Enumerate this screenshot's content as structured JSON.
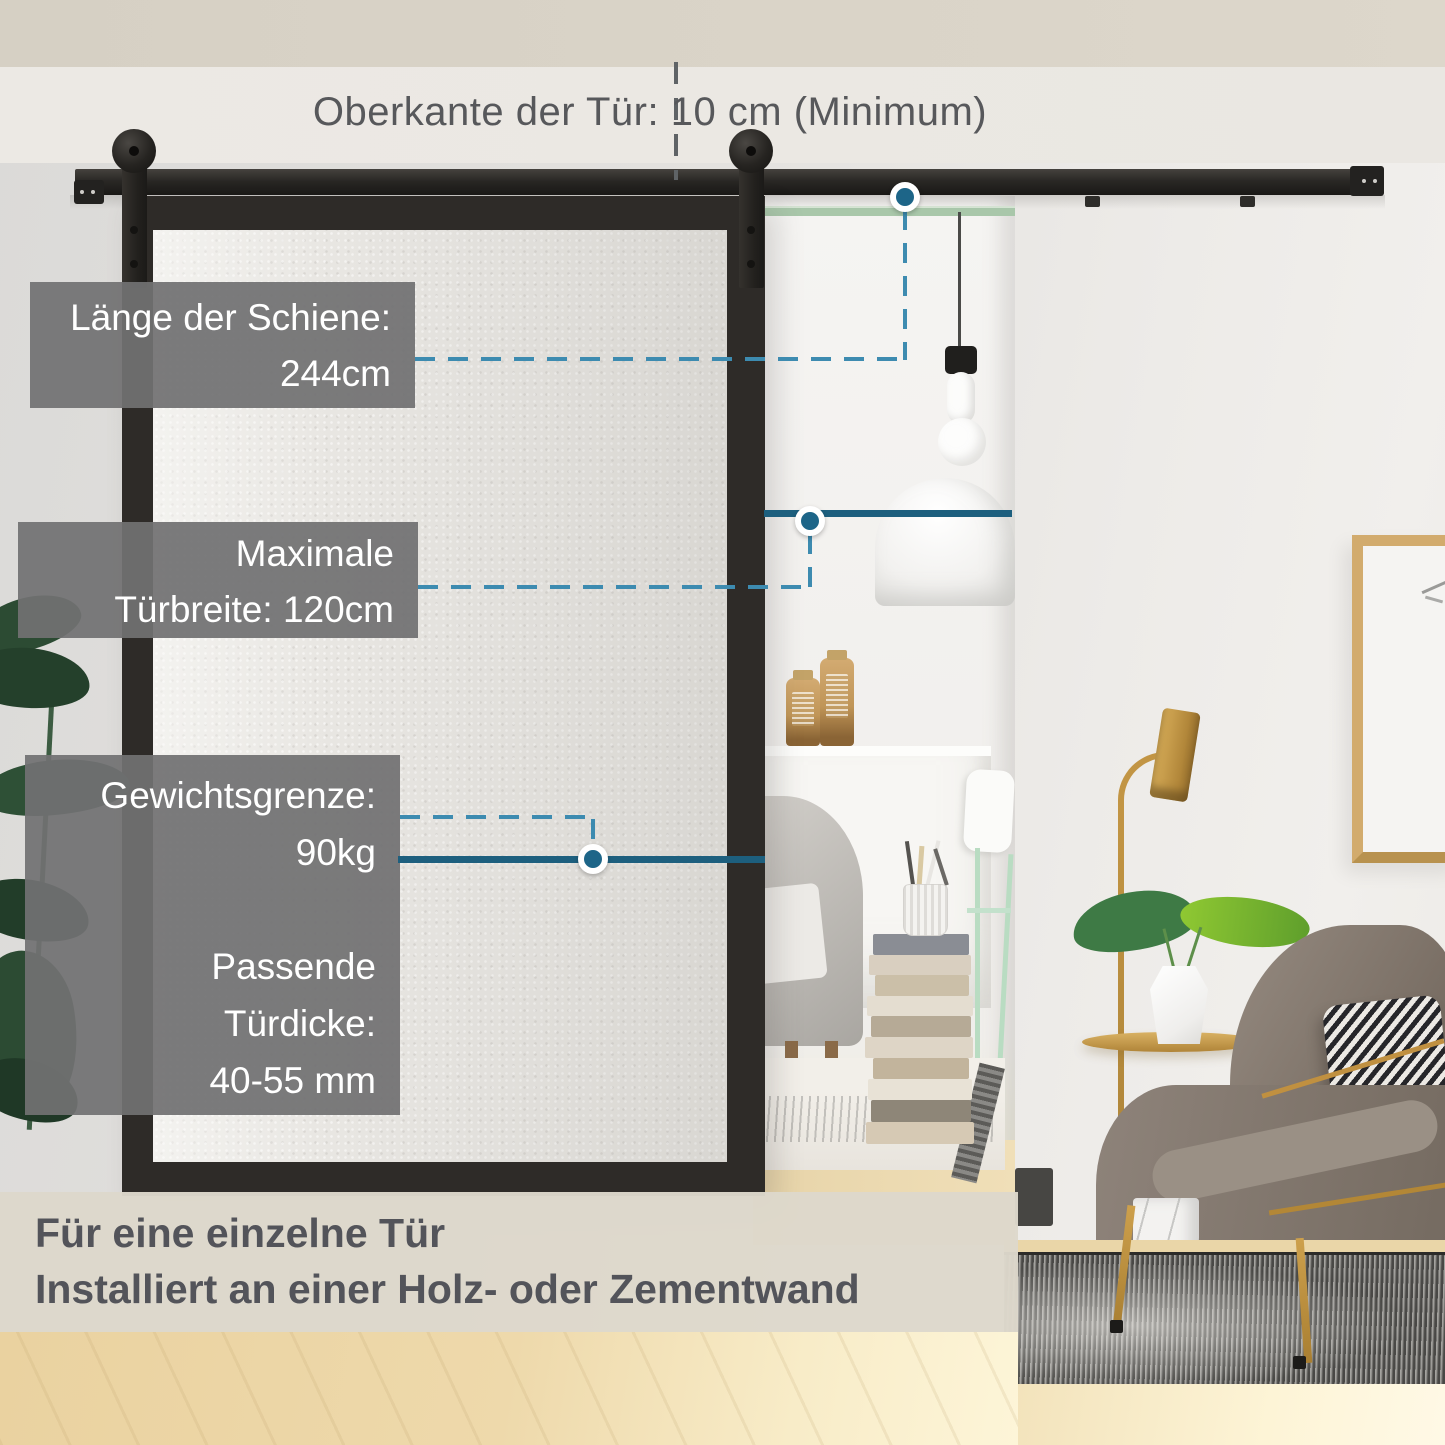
{
  "header": {
    "note": "Oberkante der Tür: 10 cm (Minimum)"
  },
  "labels": {
    "rail_length": {
      "line1": "Länge der Schiene:",
      "line2": "244cm"
    },
    "door_width": {
      "line1": "Maximale",
      "line2": "Türbreite: 120cm"
    },
    "weight": {
      "line1": "Gewichtsgrenze:",
      "line2": "90kg"
    },
    "thickness": {
      "line1": "Passende",
      "line2": "Türdicke:",
      "line3": "40-55 mm"
    }
  },
  "footer": {
    "line1": "Für eine einzelne Tür",
    "line2": "Installiert an einer Holz- oder Zementwand"
  },
  "colors": {
    "callout_solid": "#1d5f7e",
    "callout_dash": "#3d8bb0",
    "callout_dot": "#1d6588",
    "label_box_bg": "#717172",
    "label_text": "#ffffff",
    "footer_bg": "#ddd8cb",
    "footer_text": "#53545a",
    "note_text": "#57585b"
  }
}
